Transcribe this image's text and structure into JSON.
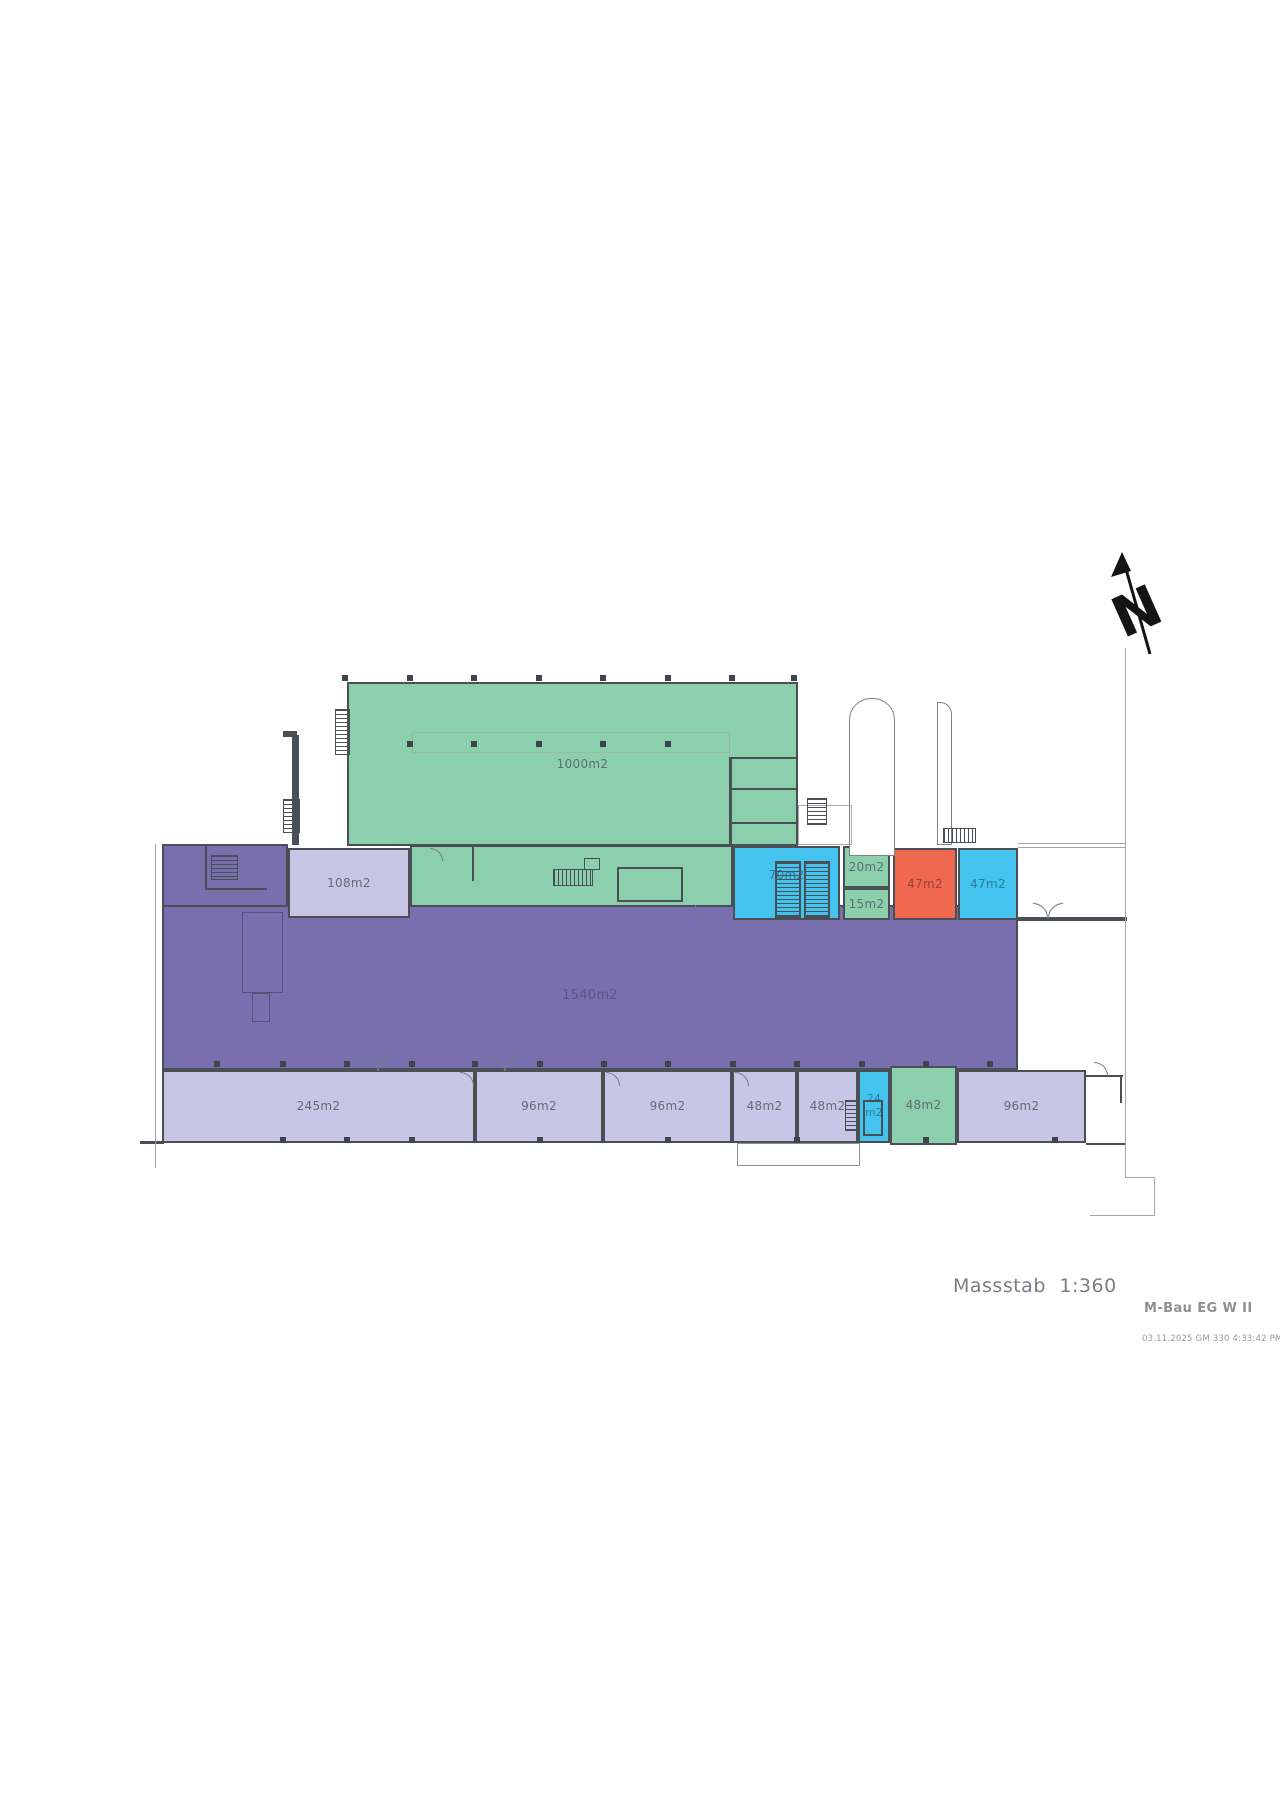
{
  "title_block": {
    "scale_label": "Massstab 1:360",
    "plan_name": "M-Bau EG W II",
    "print_timestamp": "03.11.2025 GM 330 4:33:42 PM"
  },
  "north_arrow": {
    "letter": "N"
  },
  "colors": {
    "green": "#8CCFAC",
    "purple": "#7A6FAE",
    "lavender": "#C9C5E4",
    "cyan": "#43C3EE",
    "orange": "#F0684F",
    "wall": "#4A4E55",
    "line": "#A2A6AA",
    "dot": "#3F444B",
    "label": "#636C74",
    "label_purple": "#5C5680",
    "label_cyan": "#2E7CA0",
    "label_orange": "#8F4538"
  },
  "rooms": [
    {
      "id": "wing-purple",
      "label": "",
      "fill": "purple",
      "x": 162,
      "y": 844,
      "w": 126,
      "h": 70
    },
    {
      "id": "hall-1540m2",
      "label": "1540m2",
      "fill": "purple",
      "x": 162,
      "y": 905,
      "w": 856,
      "h": 165,
      "label_color": "label_purple",
      "label_dy": 9,
      "label_size": 13
    },
    {
      "id": "hall-1000m2",
      "label": "1000m2",
      "fill": "green",
      "x": 347,
      "y": 682,
      "w": 451,
      "h": 164,
      "label_dx": 10
    },
    {
      "id": "band-green",
      "label": "",
      "fill": "green",
      "x": 410,
      "y": 845,
      "w": 323,
      "h": 62
    },
    {
      "id": "room-108m2",
      "label": "108m2",
      "fill": "lavender",
      "x": 288,
      "y": 848,
      "w": 122,
      "h": 70
    },
    {
      "id": "room-70m2",
      "label": "70m2",
      "fill": "cyan",
      "x": 733,
      "y": 846,
      "w": 107,
      "h": 74,
      "label_color": "label_cyan",
      "label_dy": -8
    },
    {
      "id": "room-20m2",
      "label": "20m2",
      "fill": "green",
      "x": 843,
      "y": 846,
      "w": 47,
      "h": 42
    },
    {
      "id": "room-15m2",
      "label": "15m2",
      "fill": "green",
      "x": 843,
      "y": 888,
      "w": 47,
      "h": 32
    },
    {
      "id": "room-47m2-a",
      "label": "47m2",
      "fill": "orange",
      "x": 893,
      "y": 848,
      "w": 64,
      "h": 72,
      "label_color": "label_orange"
    },
    {
      "id": "room-47m2-b",
      "label": "47m2",
      "fill": "cyan",
      "x": 958,
      "y": 848,
      "w": 60,
      "h": 72,
      "label_color": "label_cyan"
    },
    {
      "id": "room-245m2",
      "label": "245m2",
      "fill": "lavender",
      "x": 162,
      "y": 1070,
      "w": 313,
      "h": 73
    },
    {
      "id": "room-96m2-a",
      "label": "96m2",
      "fill": "lavender",
      "x": 475,
      "y": 1070,
      "w": 128,
      "h": 73
    },
    {
      "id": "room-96m2-b",
      "label": "96m2",
      "fill": "lavender",
      "x": 603,
      "y": 1070,
      "w": 129,
      "h": 73
    },
    {
      "id": "room-48m2-a",
      "label": "48m2",
      "fill": "lavender",
      "x": 732,
      "y": 1070,
      "w": 65,
      "h": 73
    },
    {
      "id": "room-48m2-b",
      "label": "48m2",
      "fill": "lavender",
      "x": 797,
      "y": 1070,
      "w": 61,
      "h": 73
    },
    {
      "id": "room-24m2",
      "label": "24\nm2",
      "fill": "cyan",
      "x": 858,
      "y": 1070,
      "w": 32,
      "h": 73,
      "label_color": "label_cyan",
      "label_size": 10.5
    },
    {
      "id": "room-48m2-c",
      "label": "48m2",
      "fill": "green",
      "x": 890,
      "y": 1066,
      "w": 67,
      "h": 79
    },
    {
      "id": "room-96m2-c",
      "label": "96m2",
      "fill": "lavender",
      "x": 957,
      "y": 1070,
      "w": 129,
      "h": 73
    }
  ],
  "decor": {
    "walls": [
      [
        292,
        735,
        7,
        110
      ],
      [
        283,
        731,
        14,
        6
      ],
      [
        1018,
        917,
        109,
        4
      ],
      [
        1086,
        1075,
        37,
        2
      ],
      [
        1120,
        1075,
        2,
        28
      ],
      [
        729,
        757,
        3,
        90
      ],
      [
        729,
        757,
        69,
        2
      ],
      [
        729,
        788,
        69,
        2
      ],
      [
        729,
        822,
        69,
        2
      ],
      [
        472,
        847,
        2,
        34
      ],
      [
        205,
        844,
        2,
        46
      ],
      [
        205,
        888,
        62,
        2
      ],
      [
        140,
        1141,
        24,
        3
      ],
      [
        1086,
        1143,
        39,
        2
      ]
    ],
    "lines": [
      [
        155,
        844,
        1,
        324
      ],
      [
        1125,
        648,
        1,
        529
      ],
      [
        1125,
        1177,
        30,
        1
      ],
      [
        1154,
        1177,
        1,
        39
      ],
      [
        1090,
        1215,
        65,
        1
      ],
      [
        1018,
        843,
        107,
        1
      ],
      [
        1018,
        847,
        107,
        1
      ],
      [
        765,
        1143,
        1,
        23
      ],
      [
        797,
        1143,
        1,
        23
      ],
      [
        828,
        1143,
        1,
        23
      ]
    ],
    "boxes": [
      {
        "x": 412,
        "y": 732,
        "w": 318,
        "h": 21,
        "c": "#96B8A6",
        "bw": 1
      },
      {
        "x": 617,
        "y": 867,
        "w": 66,
        "h": 35,
        "c": "#4A4E55",
        "bw": 2
      },
      {
        "x": 737,
        "y": 1143,
        "w": 123,
        "h": 23,
        "c": "#8B9094",
        "bw": 1,
        "bg": "#ffffff"
      },
      {
        "x": 849,
        "y": 698,
        "w": 46,
        "h": 158,
        "c": "#7D8287",
        "bw": 1,
        "r": "22px 22px 0 0",
        "bg": "#ffffff"
      },
      {
        "x": 937,
        "y": 702,
        "w": 15,
        "h": 143,
        "c": "#7D8287",
        "bw": 1,
        "r": "0 12px 0 0",
        "bg": "#ffffff"
      },
      {
        "x": 798,
        "y": 805,
        "w": 54,
        "h": 40,
        "c": "#AAACB2",
        "bw": 1
      },
      {
        "x": 242,
        "y": 912,
        "w": 41,
        "h": 81,
        "c": "#585278",
        "bw": 1
      },
      {
        "x": 252,
        "y": 993,
        "w": 18,
        "h": 29,
        "c": "#585278",
        "bw": 1
      },
      {
        "x": 863,
        "y": 1100,
        "w": 20,
        "h": 36,
        "c": "#4A4E55",
        "bw": 2
      },
      {
        "x": 584,
        "y": 858,
        "w": 16,
        "h": 12,
        "c": "#4A4E55",
        "bw": 1
      }
    ],
    "stairs": [
      {
        "x": 283,
        "y": 799,
        "w": 17,
        "h": 34,
        "dir": "v",
        "bw": 1
      },
      {
        "x": 335,
        "y": 709,
        "w": 15,
        "h": 46,
        "dir": "v",
        "bw": 1
      },
      {
        "x": 775,
        "y": 861,
        "w": 26,
        "h": 57,
        "dir": "v",
        "bw": 2
      },
      {
        "x": 804,
        "y": 861,
        "w": 26,
        "h": 57,
        "dir": "v",
        "bw": 2
      },
      {
        "x": 807,
        "y": 798,
        "w": 20,
        "h": 27,
        "dir": "v",
        "bw": 1
      },
      {
        "x": 943,
        "y": 828,
        "w": 33,
        "h": 15,
        "dir": "h",
        "bw": 1
      },
      {
        "x": 211,
        "y": 855,
        "w": 27,
        "h": 25,
        "dir": "v",
        "bw": 1
      },
      {
        "x": 845,
        "y": 1100,
        "w": 15,
        "h": 31,
        "dir": "v",
        "bw": 1
      },
      {
        "x": 553,
        "y": 869,
        "w": 40,
        "h": 17,
        "dir": "h",
        "bw": 1
      }
    ],
    "dots": [
      {
        "y": 678,
        "xs": [
          345,
          410,
          474,
          539,
          603,
          668,
          732,
          794
        ]
      },
      {
        "y": 744,
        "xs": [
          410,
          474,
          539,
          603,
          668
        ]
      },
      {
        "y": 1064,
        "xs": [
          217,
          283,
          347,
          412,
          475,
          540,
          604,
          668,
          733,
          797,
          862,
          926,
          990
        ]
      },
      {
        "y": 1140,
        "xs": [
          283,
          347,
          412,
          540,
          668,
          797,
          926,
          1055
        ]
      }
    ],
    "arcs": [
      {
        "x": 363,
        "y": 1056,
        "s": 15,
        "k": "tr"
      },
      {
        "x": 378,
        "y": 1056,
        "s": 15,
        "k": "tl"
      },
      {
        "x": 490,
        "y": 1056,
        "s": 15,
        "k": "tr"
      },
      {
        "x": 505,
        "y": 1056,
        "s": 15,
        "k": "tl"
      },
      {
        "x": 1033,
        "y": 903,
        "s": 15,
        "k": "tr"
      },
      {
        "x": 1048,
        "y": 903,
        "s": 15,
        "k": "tl"
      },
      {
        "x": 460,
        "y": 1072,
        "s": 14,
        "k": "tr"
      },
      {
        "x": 606,
        "y": 1072,
        "s": 14,
        "k": "tr"
      },
      {
        "x": 735,
        "y": 1072,
        "s": 14,
        "k": "tr"
      },
      {
        "x": 1094,
        "y": 1062,
        "s": 14,
        "k": "tr"
      },
      {
        "x": 430,
        "y": 848,
        "s": 13,
        "k": "tr"
      },
      {
        "x": 695,
        "y": 905,
        "s": 13,
        "k": "bl"
      }
    ]
  }
}
